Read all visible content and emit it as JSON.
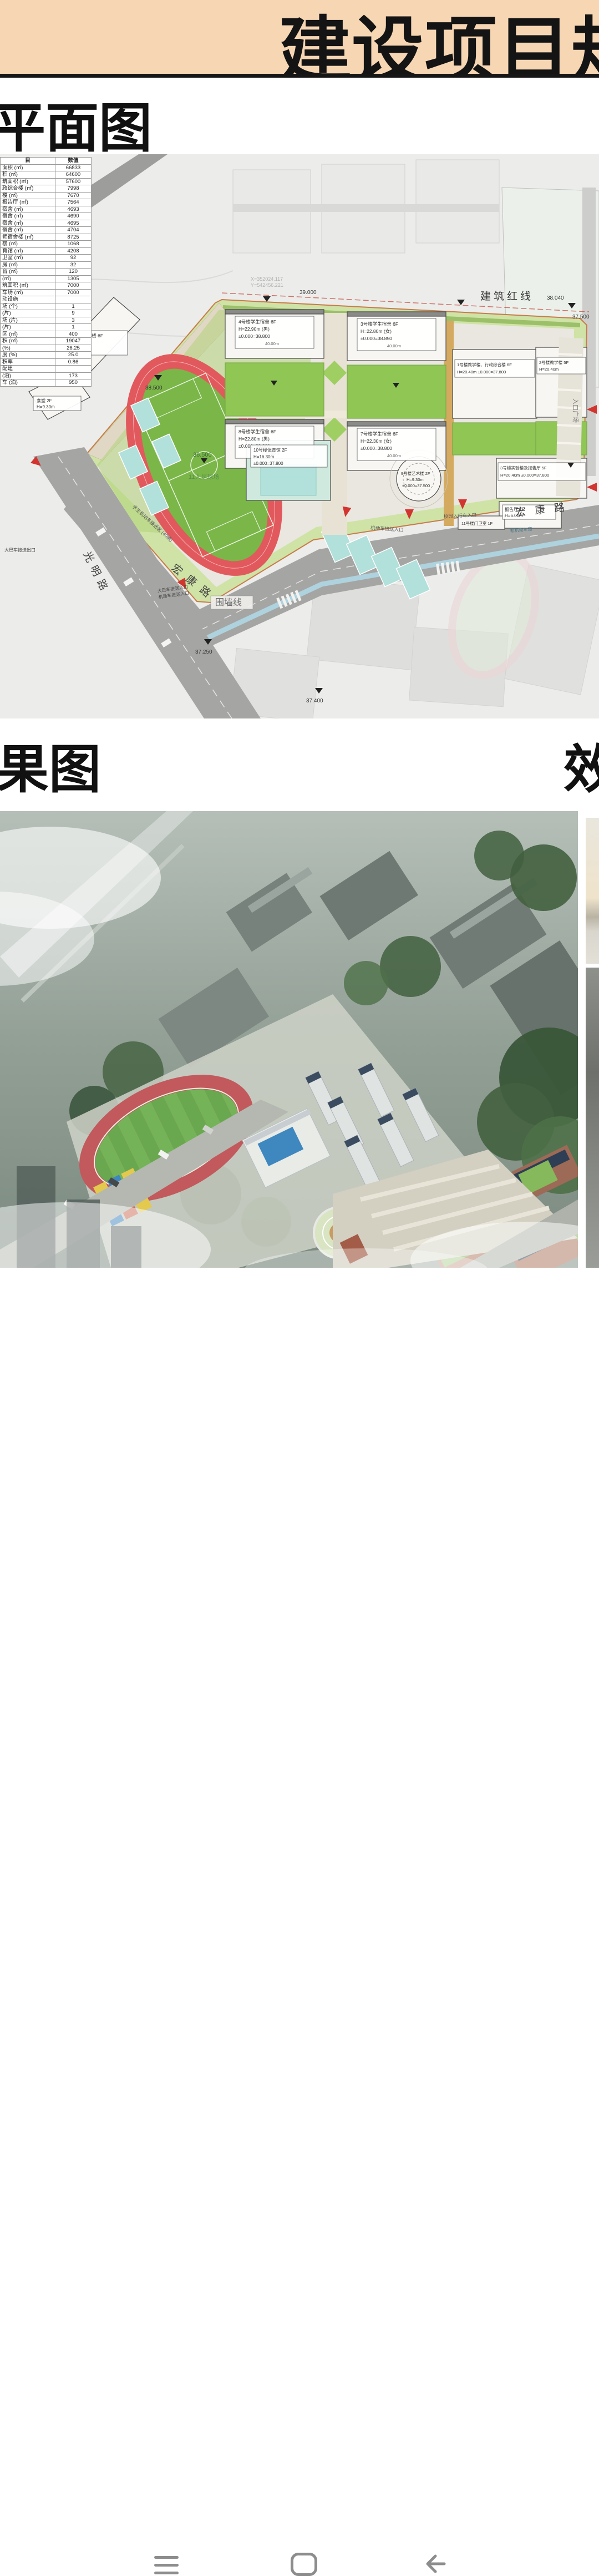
{
  "banner": {
    "title": "建设项目规",
    "bg_color": "#f6d6b3"
  },
  "sections": {
    "plan_title": "平面图",
    "render_title_left": "果图",
    "render_title_right": "效"
  },
  "table": {
    "col_item": "目",
    "col_value": "数值",
    "rows": [
      {
        "label": "面积 (㎡)",
        "value": "66833"
      },
      {
        "label": "积 (㎡)",
        "value": "64600"
      },
      {
        "label": "筑面积 (㎡)",
        "value": "57600"
      },
      {
        "label": "政综合楼 (㎡)",
        "value": "7998"
      },
      {
        "label": "楼 (㎡)",
        "value": "7670"
      },
      {
        "label": "报告厅 (㎡)",
        "value": "7564"
      },
      {
        "label": "宿舍 (㎡)",
        "value": "4693"
      },
      {
        "label": "宿舍 (㎡)",
        "value": "4690"
      },
      {
        "label": "宿舍 (㎡)",
        "value": "4695"
      },
      {
        "label": "宿舍 (㎡)",
        "value": "4704"
      },
      {
        "label": "师宿舍楼 (㎡)",
        "value": "8725"
      },
      {
        "label": "楼 (㎡)",
        "value": "1068"
      },
      {
        "label": "育馆 (㎡)",
        "value": "4208"
      },
      {
        "label": "卫室 (㎡)",
        "value": "92"
      },
      {
        "label": "房 (㎡)",
        "value": "32"
      },
      {
        "label": "台 (㎡)",
        "value": "120"
      },
      {
        "label": "(㎡)",
        "value": "1305"
      },
      {
        "label": "筑面积 (㎡)",
        "value": "7000"
      },
      {
        "label": "车场 (㎡)",
        "value": "7000"
      },
      {
        "label": "动设施",
        "value": ""
      },
      {
        "label": "场 (个)",
        "value": "1"
      },
      {
        "label": "(片)",
        "value": "9"
      },
      {
        "label": "场 (片)",
        "value": "3"
      },
      {
        "label": "(片)",
        "value": "1"
      },
      {
        "label": "区 (㎡)",
        "value": "400"
      },
      {
        "label": "积 (㎡)",
        "value": "19047"
      },
      {
        "label": "(%)",
        "value": "26.25"
      },
      {
        "label": "度 (%)",
        "value": "25.0"
      },
      {
        "label": "积率",
        "value": "0.86"
      },
      {
        "label": "配建",
        "value": ""
      },
      {
        "label": "(泊)",
        "value": "173"
      },
      {
        "label": "车 (泊)",
        "value": "950"
      }
    ]
  },
  "site_plan": {
    "red_line_label": "建筑红线",
    "wall_line_label": "围墙线",
    "road_guangming": "光明路",
    "road_hongkang_1": "宏康路",
    "road_hongkang_2": "宏康路",
    "entrance_plaza": "入口广场",
    "soccer_field": "11人足球场",
    "veh_pickup_entry": "机动车接送入口",
    "campus_gate_entry": "校园入行车入口",
    "student_pickup_zone": "学生机动车接送区 (40辆)",
    "bus_entry_l1": "大巴车接送入口",
    "bus_entry_l2": "机动车接送入口",
    "bus_exit": "大巴车接送出口",
    "bike_lane": "非机动车道",
    "coord_x": "X=352024.117",
    "coord_y": "Y=542456.221",
    "elev_39000": "39.000",
    "elev_38040": "38.040",
    "elev_37500": "37.500",
    "elev_38500": "38.500",
    "elev_36500": "36.500",
    "elev_37250": "37.250",
    "elev_37400": "37.400",
    "buildings": [
      {
        "l1": "5号楼教官及教师宿舍楼 6F",
        "l2": "H=21.90m",
        "l3": "±0.000=38.300"
      },
      {
        "l1": "食堂 2F",
        "l2": "H=9.30m"
      },
      {
        "l1": "4号楼学生宿舍 6F",
        "l2": "H=22.90m (男)",
        "l3": "±0.000=38.800",
        "l4": "40.00m"
      },
      {
        "l1": "3号楼学生宿舍 6F",
        "l2": "H=22.80m (女)",
        "l3": "±0.000=38.850",
        "l4": "40.00m"
      },
      {
        "l1": "8号楼学生宿舍 6F",
        "l2": "H=22.80m (男)",
        "l3": "±0.000=38.800",
        "l4": "40.00m"
      },
      {
        "l1": "7号楼学生宿舍 6F",
        "l2": "H=22.30m (女)",
        "l3": "±0.000=38.800",
        "l4": "40.00m"
      },
      {
        "l1": "1号楼教学楼、行政综合楼 6F",
        "l2": "H=20.40m ±0.000=37.800"
      },
      {
        "l1": "2号楼教学楼 5F",
        "l2": "H=20.40m"
      },
      {
        "l1": "3号楼实验楼及报告厅 5F",
        "l2": "H=20.40m ±0.000=37.800"
      },
      {
        "l1": "报告厅 1F",
        "l2": "H=6.00m"
      },
      {
        "l1": "10号楼体育馆 2F",
        "l2": "H=16.30m",
        "l3": "±0.000=37.800"
      },
      {
        "l1": "9号楼艺术楼 2F",
        "l2": "H=9.30m",
        "l3": "±0.000=37.500"
      },
      {
        "l1": "11号楼门卫室 1F"
      }
    ],
    "colors": {
      "track_ring": "#e2595d",
      "field_green": "#7ab648",
      "court_teal": "#b2e0da",
      "campus_green": "#cfe3a6",
      "road_gray": "#a5a5a3",
      "arrow_red": "#d23430"
    }
  },
  "nav": {
    "icons": [
      "menu-icon",
      "home-icon",
      "back-icon"
    ]
  }
}
